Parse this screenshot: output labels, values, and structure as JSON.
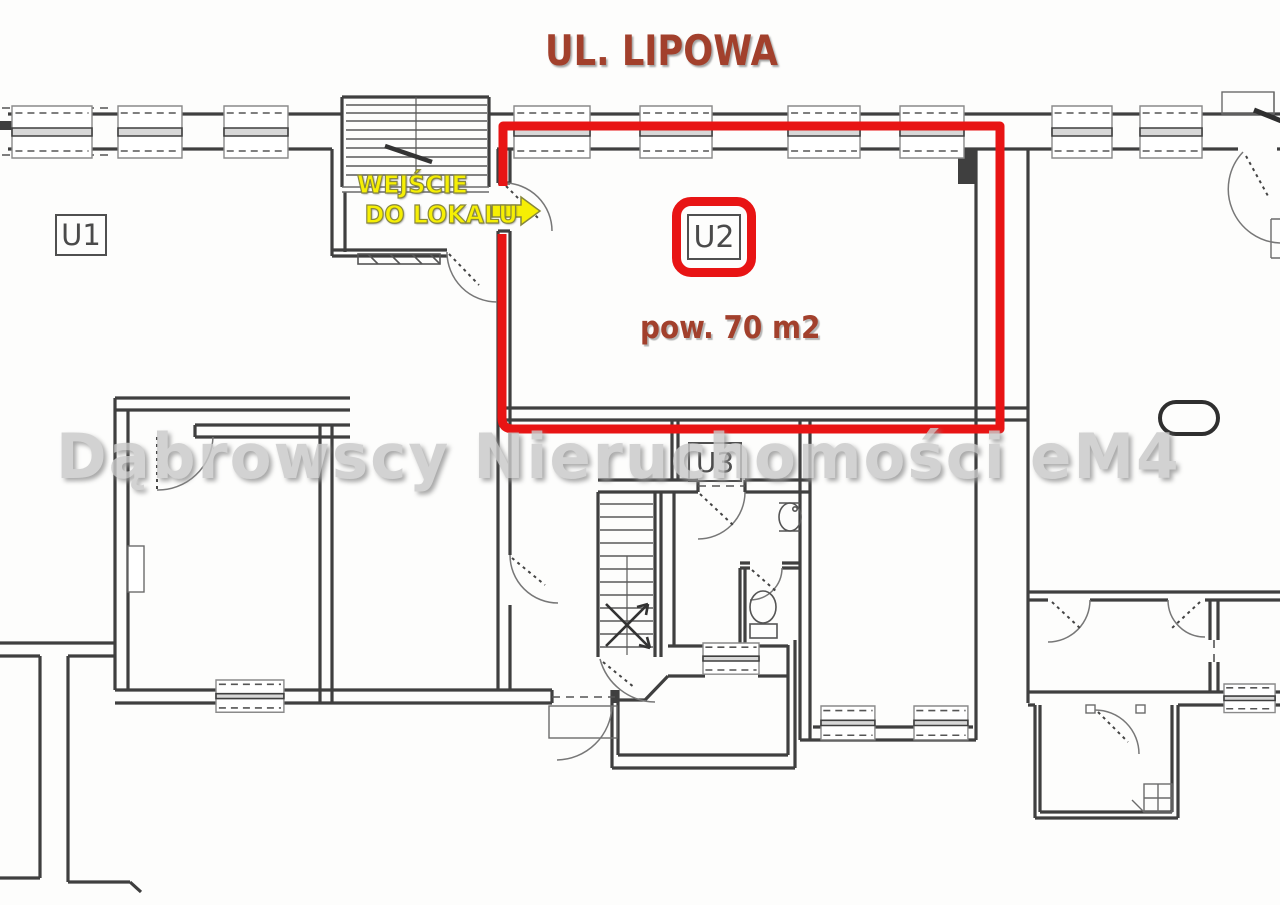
{
  "street_label": {
    "text": "UL. LIPOWA"
  },
  "entrance": {
    "line1": "WEJŚCIE",
    "line2": "DO LOKALU"
  },
  "units": {
    "u1": "U1",
    "u2": "U2",
    "u3": "U3"
  },
  "area": {
    "text": "pow. 70 m2"
  },
  "watermark": {
    "text": "Dąbrowscy Nieruchomości eM4"
  },
  "colors": {
    "highlight_red": "#e81414",
    "label_brown": "#a2402c",
    "entrance_yellow": "#f6ef04",
    "wall_dark": "#3f3f3f",
    "watermark_gray": "#c9c9c9"
  }
}
